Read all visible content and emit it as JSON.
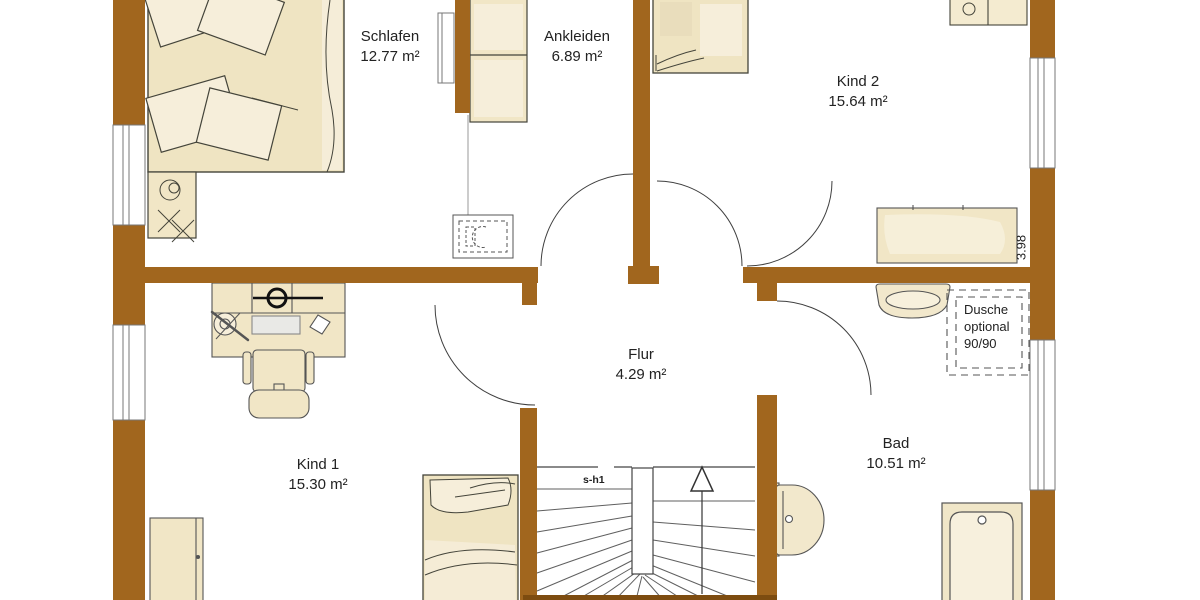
{
  "plan": {
    "type": "floor-plan",
    "colors": {
      "wall": "#A1661E",
      "wall_dark": "#7D4C10",
      "furniture_fill": "#EFE4C2",
      "furniture_light": "#F6EEDA",
      "outline": "#44443A",
      "background": "#FFFFFF",
      "text": "#222222"
    },
    "rooms": {
      "schlafen": {
        "name": "Schlafen",
        "area": "12.77 m²"
      },
      "ankleiden": {
        "name": "Ankleiden",
        "area": "6.89 m²"
      },
      "kind2": {
        "name": "Kind 2",
        "area": "15.64 m²"
      },
      "flur": {
        "name": "Flur",
        "area": "4.29 m²"
      },
      "kind1": {
        "name": "Kind 1",
        "area": "15.30 m²"
      },
      "bad": {
        "name": "Bad",
        "area": "10.51 m²"
      }
    },
    "annotations": {
      "shower_note": {
        "line1": "Dusche",
        "line2": "optional",
        "line3": "90/90"
      },
      "stair_label": "s-h1",
      "dimension": "3.98"
    }
  }
}
